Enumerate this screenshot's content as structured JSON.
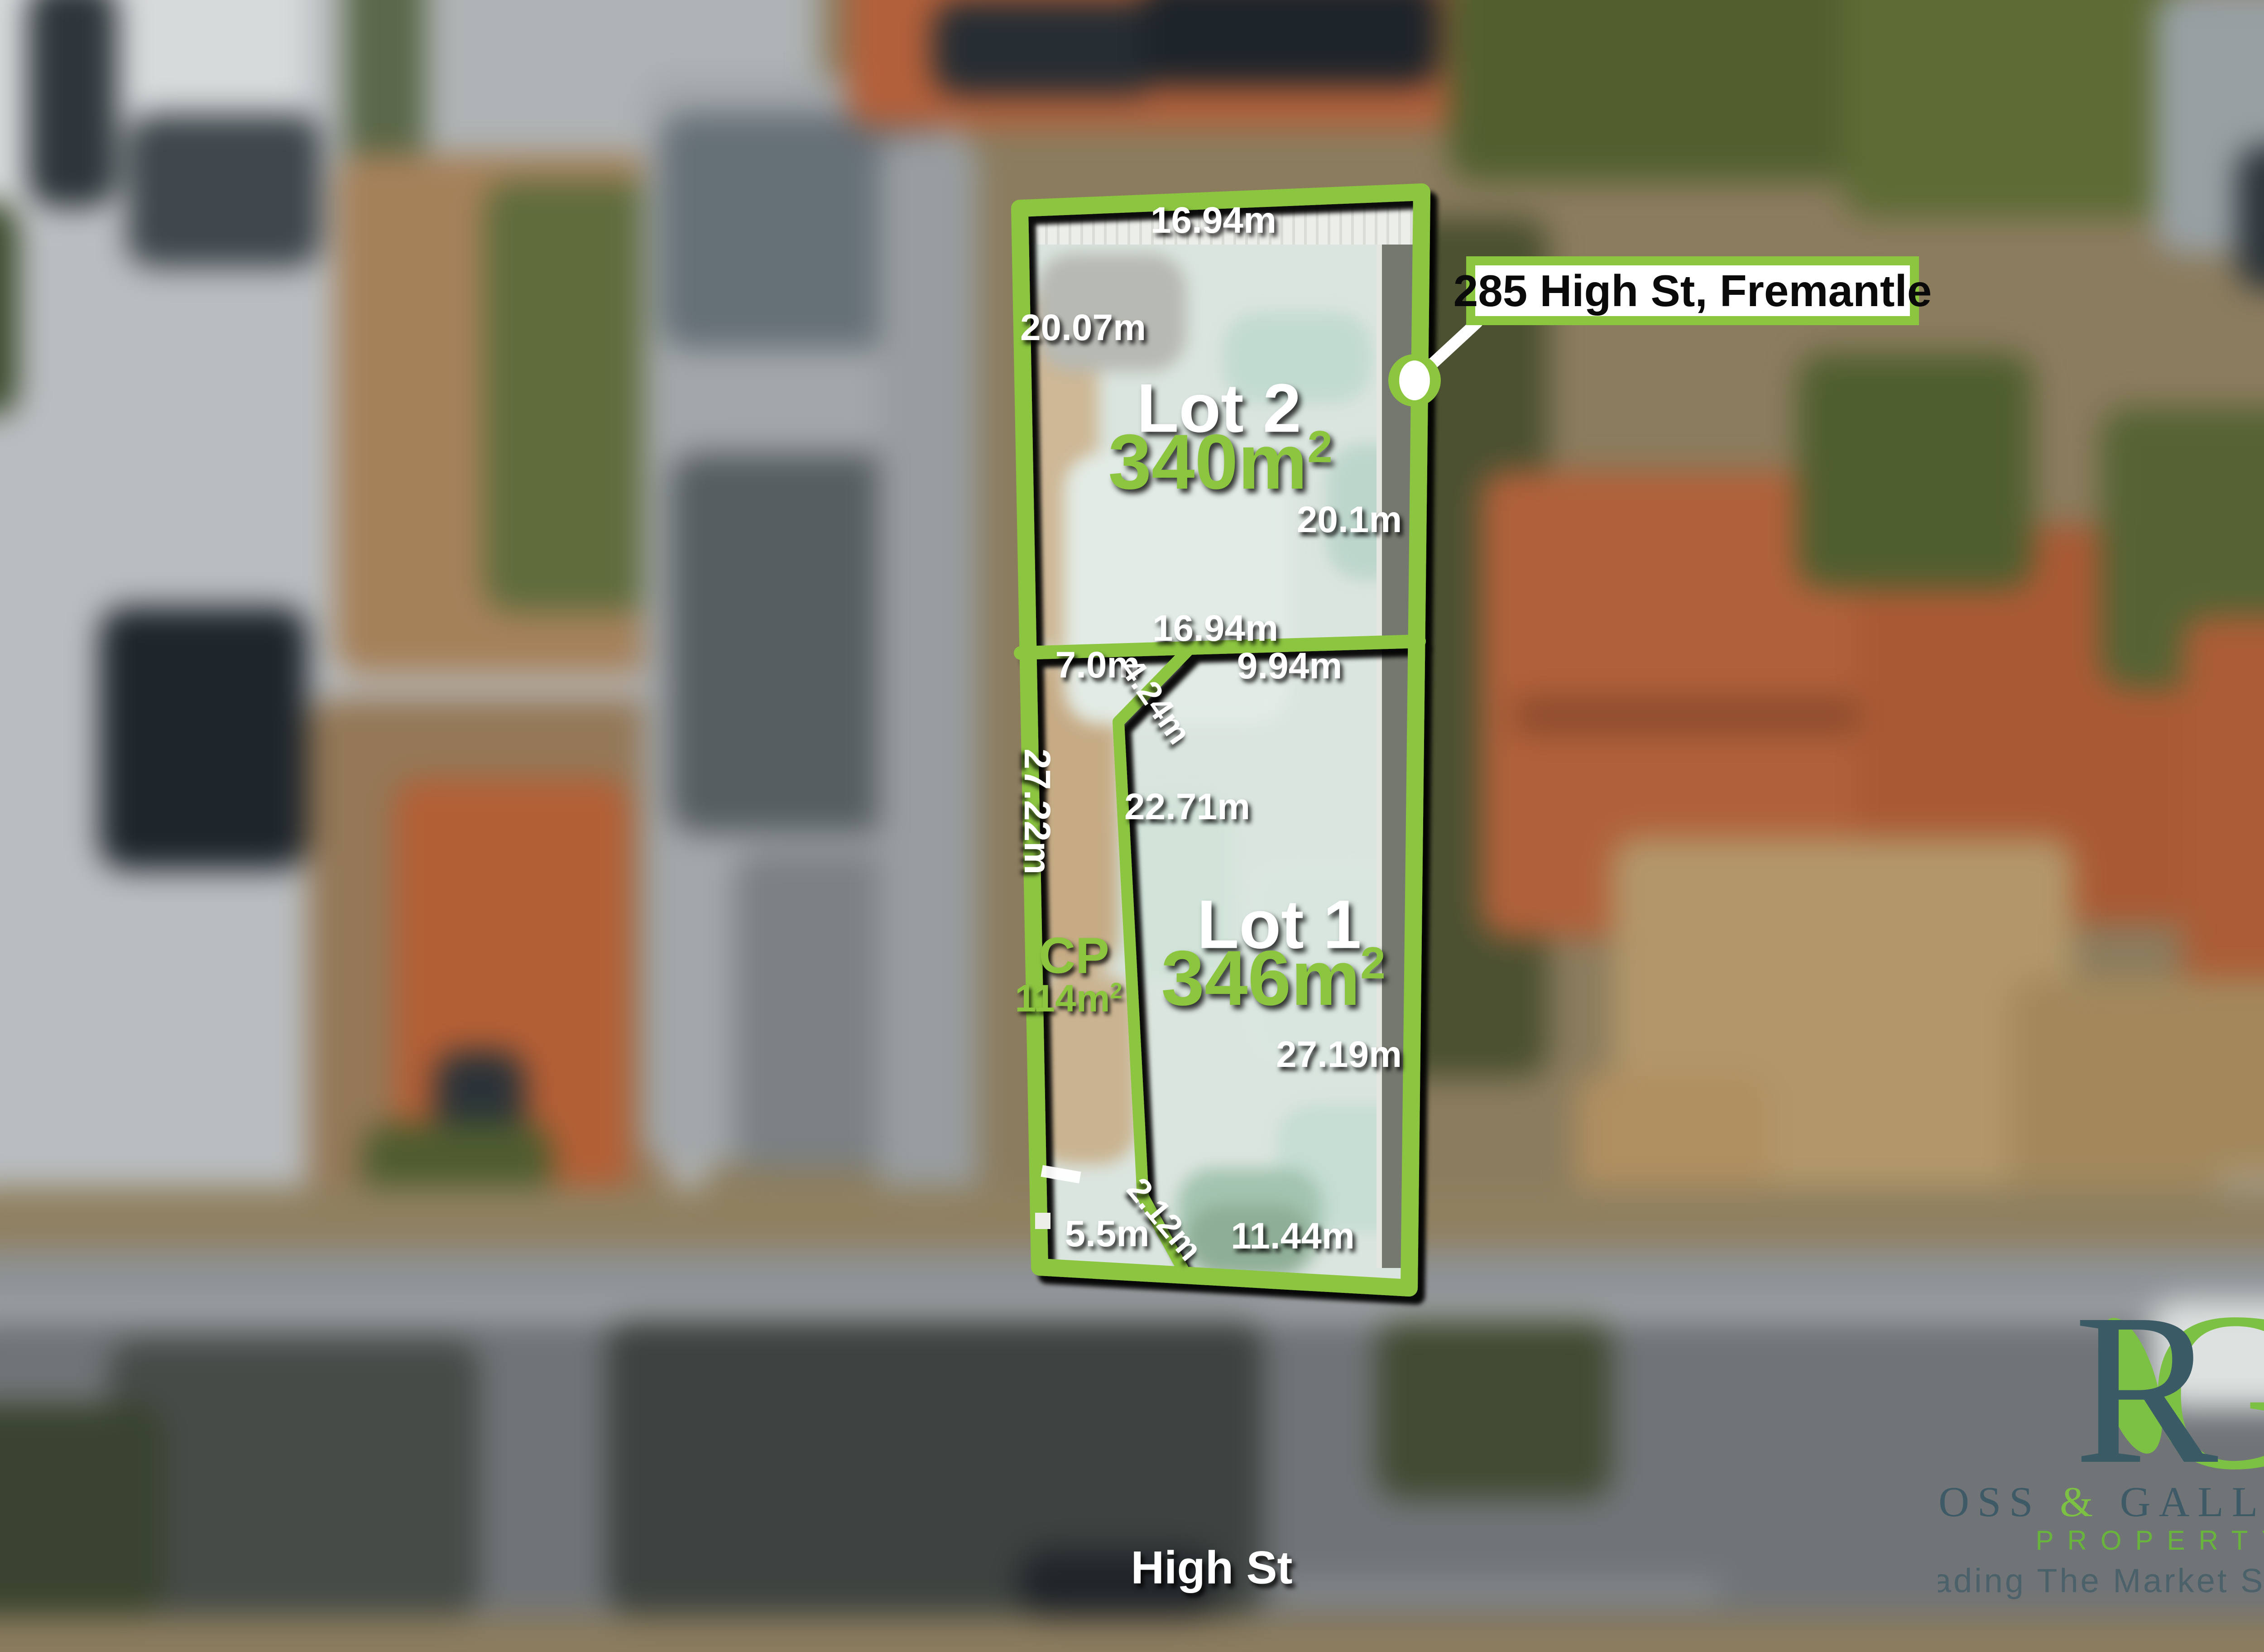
{
  "callout": {
    "text": "285 High St, Fremantle"
  },
  "street": {
    "label": "High St"
  },
  "site": {
    "lot2": {
      "name": "Lot 2",
      "area_base": "340m",
      "area_sup": "2",
      "dim_top": "16.94m",
      "dim_left": "20.07m",
      "dim_right": "20.1m",
      "dim_bottom": "16.94m"
    },
    "lot1": {
      "name": "Lot 1",
      "area_base": "346m",
      "area_sup": "2",
      "dim_north_left": "7.0m",
      "dim_north_diag": "4.24m",
      "dim_north_right": "9.94m",
      "dim_west": "27.22m",
      "dim_inner": "22.71m",
      "dim_east": "27.19m",
      "dim_south_left": "5.5m",
      "dim_south_diag": "2.12m",
      "dim_south_right": "11.44m"
    },
    "cp": {
      "label": "CP",
      "area_base": "114m",
      "area_sup": "2"
    }
  },
  "logo": {
    "monogram_r": "R",
    "monogram_g": "G",
    "name_part1": "ROSS ",
    "ampersand": "&",
    "name_part2": " GALLOWAY",
    "subtitle": "PROPERTY",
    "tagline": "Leading The Market Since 1966"
  },
  "colors": {
    "accent_green": "#8CC63F",
    "logo_slate": "#3E5A66",
    "logo_green": "#7CC143",
    "callout_background": "#FFFFFF",
    "label_white": "#FFFFFF"
  }
}
